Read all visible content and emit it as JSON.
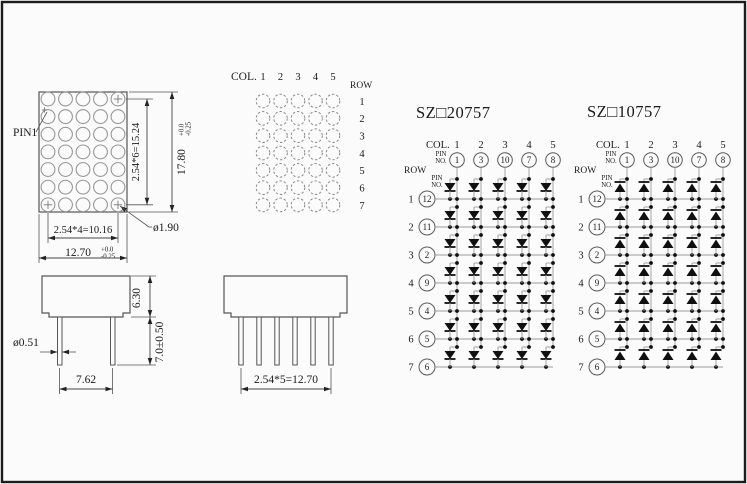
{
  "front_view": {
    "pin1": "PIN1",
    "dim_row_span": "2.54*6=15.24",
    "dim_height": "17.80",
    "tol_plus": "+0.0",
    "tol_minus": "-0.25",
    "dim_col_span": "2.54*4=10.16",
    "dim_width": "12.70",
    "dim_dot_dia": "ø1.90",
    "cols": 5,
    "rows": 7
  },
  "dot_pattern": {
    "col_label": "COL.",
    "row_label": "ROW",
    "col_numbers": [
      "1",
      "2",
      "3",
      "4",
      "5"
    ],
    "row_numbers": [
      "1",
      "2",
      "3",
      "4",
      "5",
      "6",
      "7"
    ]
  },
  "circuits": {
    "col_label": "COL.",
    "pin_label_line1": "PIN",
    "pin_label_line2": "NO.",
    "row_label": "ROW",
    "col_numbers": [
      "1",
      "2",
      "3",
      "4",
      "5"
    ],
    "col_pins": [
      "1",
      "3",
      "10",
      "7",
      "8"
    ],
    "row_numbers": [
      "1",
      "2",
      "3",
      "4",
      "5",
      "6",
      "7"
    ],
    "row_pins": [
      "12",
      "11",
      "2",
      "9",
      "4",
      "5",
      "6"
    ],
    "left": {
      "title": "SZ□20757",
      "diode_direction": "down"
    },
    "right": {
      "title": "SZ□10757",
      "diode_direction": "up"
    }
  },
  "side_view_front": {
    "dim_body_height": "6.30",
    "dim_pin_length": "7.0±0.50",
    "dim_pin_diameter": "ø0.51",
    "dim_pin_spacing": "7.62"
  },
  "side_view_side": {
    "dim_pin_pitch": "2.54*5=12.70"
  }
}
